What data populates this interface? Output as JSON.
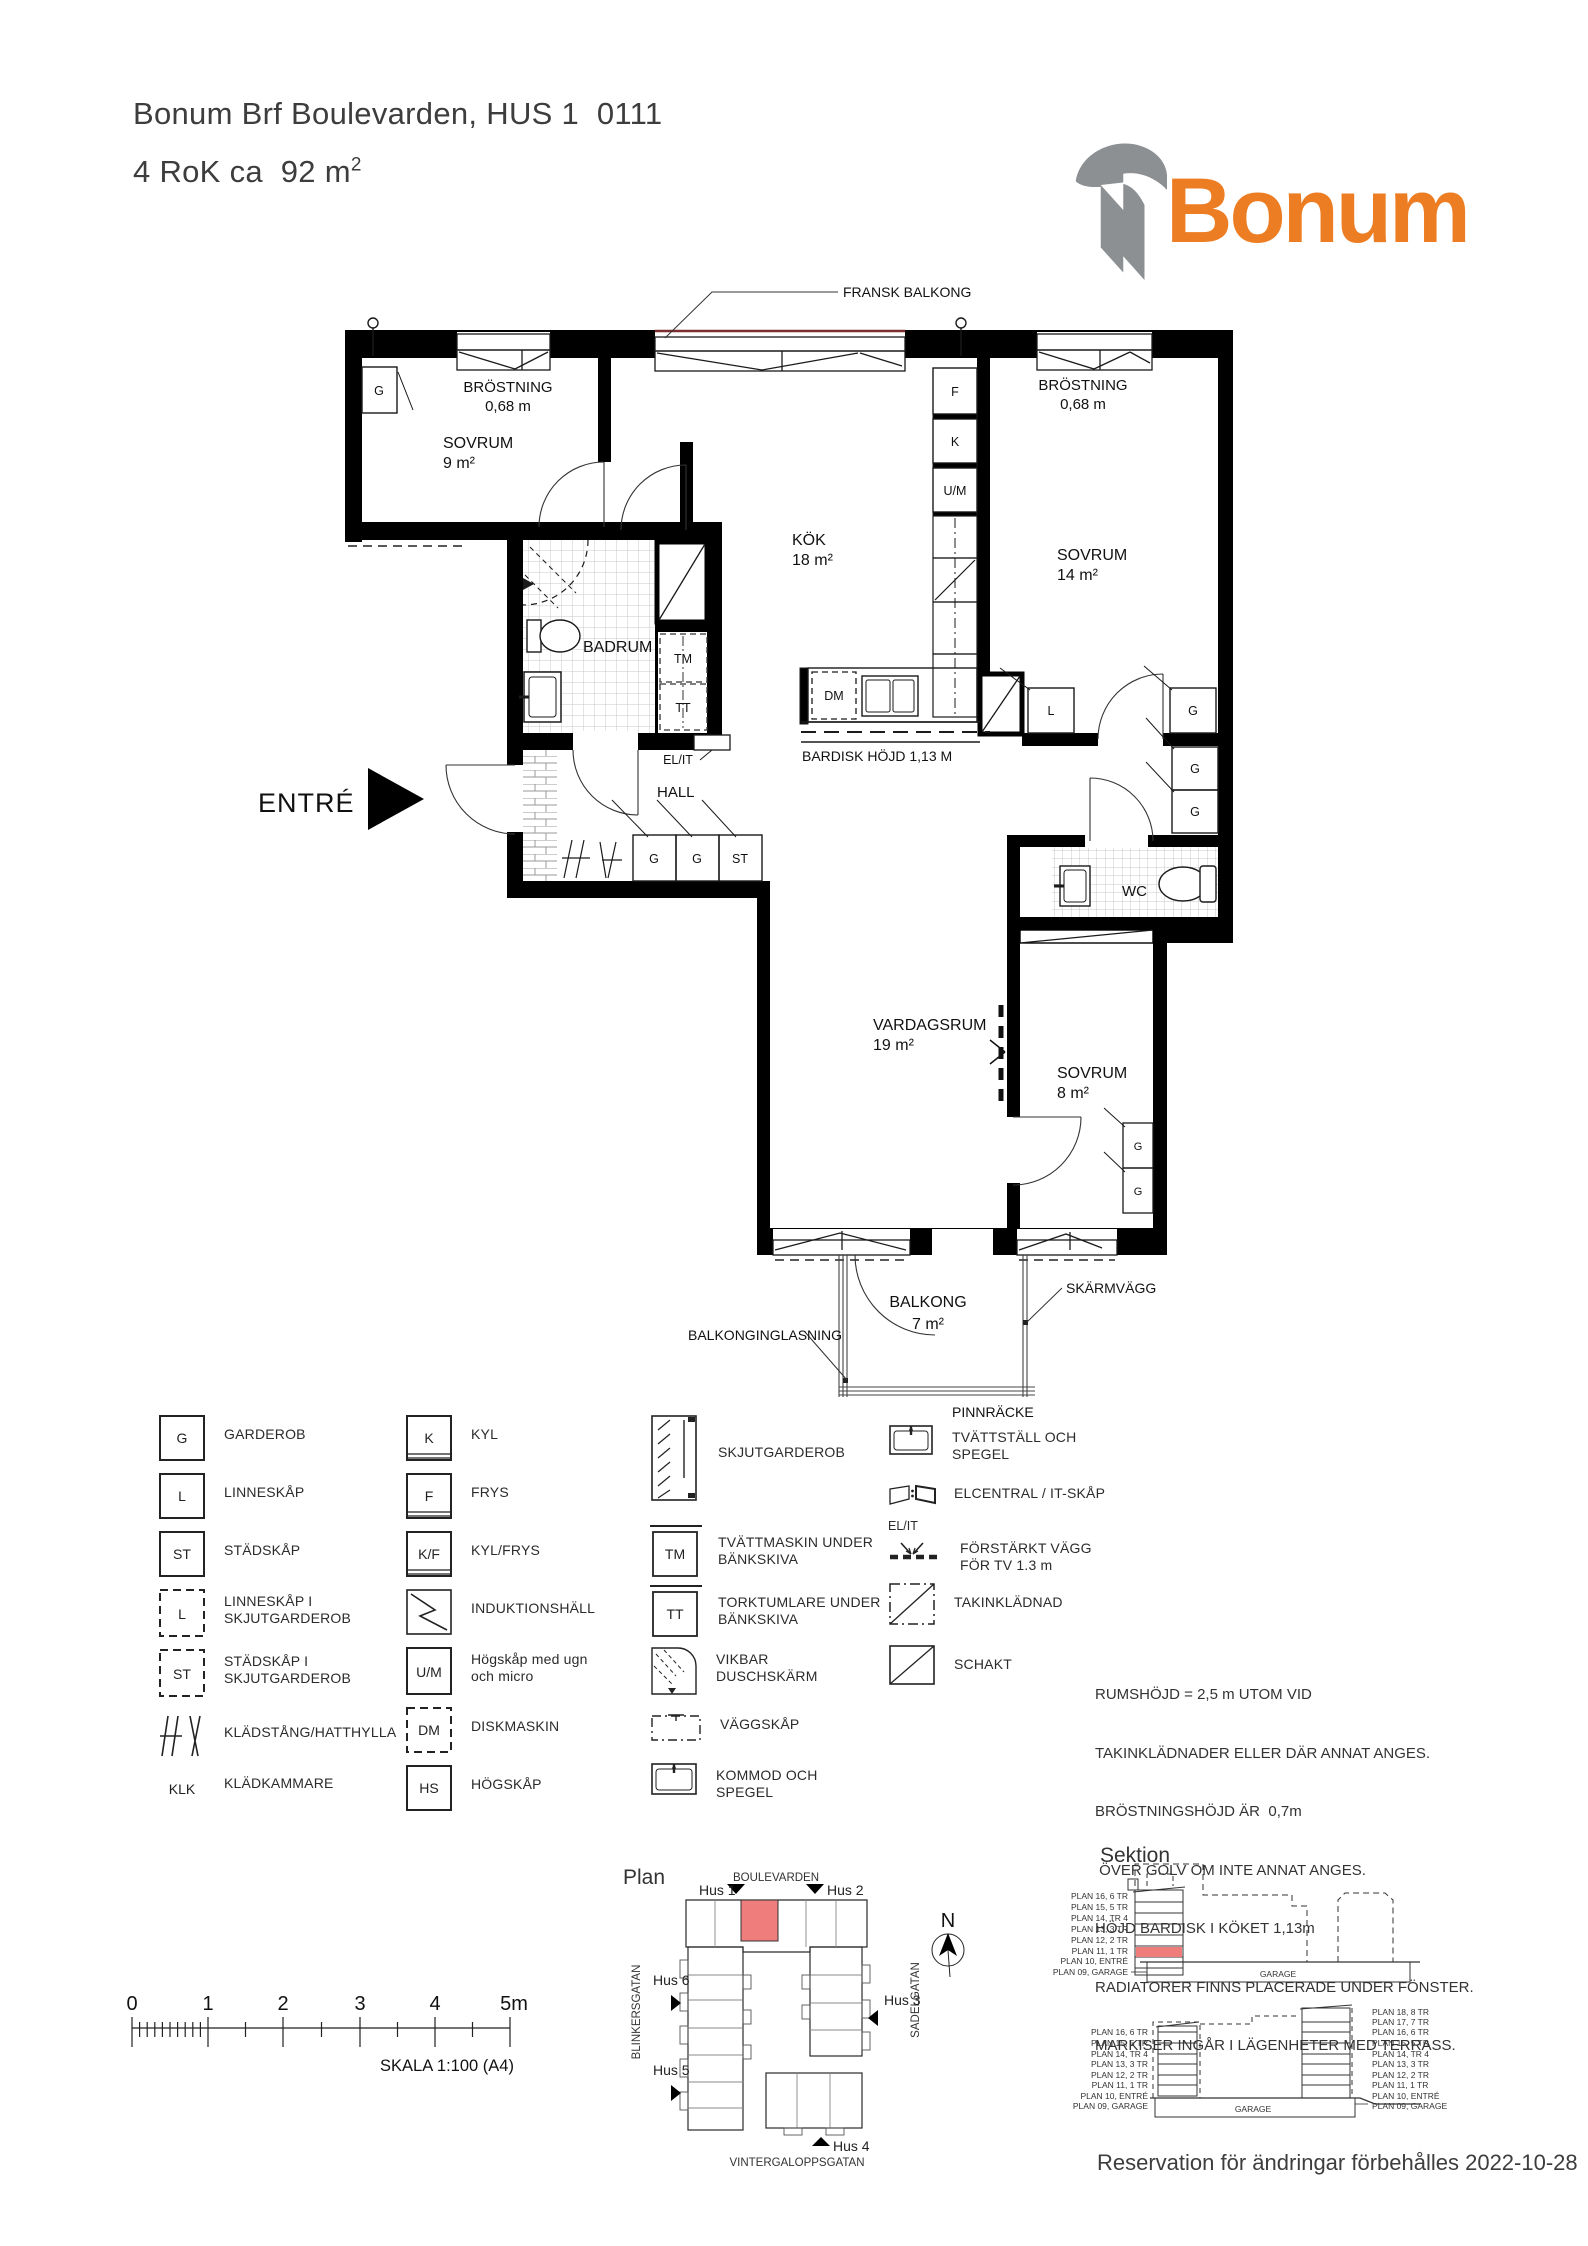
{
  "header": {
    "line1": "Bonum Brf Boulevarden, HUS 1  0111",
    "line2": "4 RoK ca  92 m",
    "line2_sup": "2"
  },
  "logo": {
    "text": "Bonum",
    "orange": "#ED7D23",
    "gray": "#8D9093"
  },
  "floorplan": {
    "fransk_balkong": "FRANSK BALKONG",
    "brostning": "BRÖSTNING",
    "brostning_val": "0,68 m",
    "sovrum9": "SOVRUM",
    "sovrum9_area": "9 m²",
    "kok": "KÖK",
    "kok_area": "18 m²",
    "sovrum14": "SOVRUM",
    "sovrum14_area": "14 m²",
    "badrum": "BADRUM",
    "hall": "HALL",
    "entre": "ENTRÉ",
    "elit": "EL/IT",
    "bardisk": "BARDISK HÖJD 1,13 M",
    "vardagsrum": "VARDAGSRUM",
    "vardagsrum_area": "19 m²",
    "sovrum8": "SOVRUM",
    "sovrum8_area": "8 m²",
    "wc": "WC",
    "balkong": "BALKONG",
    "balkong_area": "7 m²",
    "skarmvagg": "SKÄRMVÄGG",
    "balkonginglasning": "BALKONGINGLASNING",
    "pinnracke": "PINNRÄCKE",
    "cab": {
      "g": "G",
      "l": "L",
      "st": "ST",
      "f": "F",
      "k": "K",
      "um": "U/M",
      "tm": "TM",
      "tt": "TT",
      "dm": "DM"
    }
  },
  "legend": {
    "col1": [
      {
        "key": "G",
        "label": "GARDEROB"
      },
      {
        "key": "L",
        "label": "LINNESKÅP"
      },
      {
        "key": "ST",
        "label": "STÄDSKÅP"
      },
      {
        "key": "L",
        "label": "LINNESKÅP I",
        "label2": "SKJUTGARDEROB"
      },
      {
        "key": "ST",
        "label": "STÄDSKÅP I",
        "label2": "SKJUTGARDEROB"
      },
      {
        "key": "",
        "label": "KLÄDSTÅNG/HATTHYLLA"
      },
      {
        "key": "KLK",
        "label": "KLÄDKAMMARE"
      }
    ],
    "col2": [
      {
        "key": "K",
        "label": "KYL"
      },
      {
        "key": "F",
        "label": "FRYS"
      },
      {
        "key": "K/F",
        "label": "KYL/FRYS"
      },
      {
        "key": "",
        "label": "INDUKTIONSHÄLL"
      },
      {
        "key": "U/M",
        "label": "Högskåp med ugn",
        "label2": "och micro"
      },
      {
        "key": "DM",
        "label": "DISKMASKIN"
      },
      {
        "key": "HS",
        "label": "HÖGSKÅP"
      }
    ],
    "col3": [
      {
        "key": "",
        "label": "SKJUTGARDEROB"
      },
      {
        "key": "TM",
        "label": "TVÄTTMASKIN UNDER",
        "label2": "BÄNKSKIVA"
      },
      {
        "key": "TT",
        "label": "TORKTUMLARE UNDER",
        "label2": "BÄNKSKIVA"
      },
      {
        "key": "",
        "label": "VIKBAR",
        "label2": "DUSCHSKÄRM"
      },
      {
        "key": "",
        "label": "VÄGGSKÅP"
      },
      {
        "key": "",
        "label": "KOMMOD OCH",
        "label2": "SPEGEL"
      }
    ],
    "col4": [
      {
        "key": "",
        "label": "TVÄTTSTÄLL OCH",
        "label2": "SPEGEL"
      },
      {
        "key": "EL/IT",
        "label": "ELCENTRAL / IT-SKÅP"
      },
      {
        "key": "",
        "label": "FÖRSTÄRKT VÄGG",
        "label2": "FÖR TV 1.3 m"
      },
      {
        "key": "",
        "label": "TAKINKLÄDNAD"
      },
      {
        "key": "",
        "label": "SCHAKT"
      }
    ]
  },
  "notes": {
    "lines": [
      "RUMSHÖJD = 2,5 m UTOM VID",
      "TAKINKLÄDNADER ELLER DÄR ANNAT ANGES.",
      "BRÖSTNINGSHÖJD ÄR  0,7m",
      " ÖVER GOLV OM INTE ANNAT ANGES.",
      "HÖJD BARDISK I KÖKET 1,13m",
      "RADIATORER FINNS PLACERADE UNDER FÖNSTER.",
      "MARKISER INGÅR I LÄGENHETER MED TERRASS."
    ]
  },
  "scalebar": {
    "t0": "0",
    "t1": "1",
    "t2": "2",
    "t3": "3",
    "t4": "4",
    "t5": "5m",
    "caption": "SKALA 1:100 (A4)"
  },
  "siteplan": {
    "title": "Plan",
    "north": "N",
    "street_top": "BOULEVARDEN",
    "street_left": "BLINKERSGATAN",
    "street_right": "SADELGATAN",
    "street_bottom": "VINTERGALOPPSGATAN",
    "hus1": "Hus 1",
    "hus2": "Hus 2",
    "hus3": "Hus 3",
    "hus4": "Hus 4",
    "hus5": "Hus 5",
    "hus6": "Hus 6",
    "highlight_color": "#EE7D7B"
  },
  "sections": {
    "title": "Sektion",
    "garage": "GARAGE",
    "s1_left": [
      "PLAN 16, 6 TR",
      "PLAN 15, 5 TR",
      "PLAN 14, TR 4",
      "PLAN 13, 3 TR",
      "PLAN 12, 2 TR",
      "PLAN 11, 1 TR",
      "PLAN 10, ENTRÉ",
      "PLAN 09, GARAGE"
    ],
    "s2_left": [
      "PLAN 16, 6 TR",
      "PLAN 15, 5 TR",
      "PLAN 14, TR 4",
      "PLAN 13, 3 TR",
      "PLAN 12, 2 TR",
      "PLAN 11, 1 TR",
      "PLAN 10, ENTRÉ",
      "PLAN 09, GARAGE"
    ],
    "s2_right": [
      "PLAN 18, 8 TR",
      "PLAN 17, 7 TR",
      "PLAN 16, 6 TR",
      "PLAN 15, 5 TR",
      "PLAN 14, TR 4",
      "PLAN 13, 3 TR",
      "PLAN 12, 2 TR",
      "PLAN 11, 1 TR",
      "PLAN 10, ENTRÉ",
      "PLAN 09, GARAGE"
    ]
  },
  "footer": {
    "text": "Reservation för ändringar förbehålles 2022-10-28"
  }
}
